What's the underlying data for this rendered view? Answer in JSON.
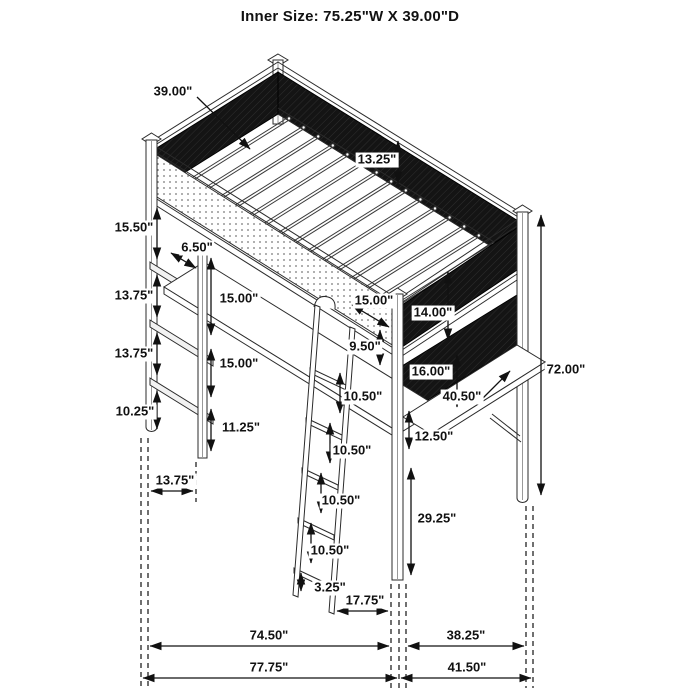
{
  "title": "Inner Size: 75.25\"W X 39.00\"D",
  "colors": {
    "line": "#2b2b2b",
    "mesh_panel": "#141414",
    "dim": "#111111",
    "background": "#ffffff"
  },
  "diagram_subject": "metal loft bed with desk, shelves and ladder",
  "labels": [
    {
      "id": "inner-depth",
      "text": "39.00\"",
      "x": 173,
      "y": 92
    },
    {
      "id": "guard-rail-height",
      "text": "13.25\"",
      "x": 377,
      "y": 160
    },
    {
      "id": "bed-to-shelf1",
      "text": "15.50\"",
      "x": 134,
      "y": 228
    },
    {
      "id": "shelf-depth",
      "text": "6.50\"",
      "x": 197,
      "y": 248
    },
    {
      "id": "shelf1-to-shelf2",
      "text": "13.75\"",
      "x": 134,
      "y": 296
    },
    {
      "id": "shelf2-to-shelf3",
      "text": "13.75\"",
      "x": 134,
      "y": 354
    },
    {
      "id": "shelf3-to-floor",
      "text": "10.25\"",
      "x": 135,
      "y": 412
    },
    {
      "id": "desk-clearance-upper",
      "text": "15.00\"",
      "x": 239,
      "y": 299
    },
    {
      "id": "desk-clearance-lower",
      "text": "15.00\"",
      "x": 239,
      "y": 364
    },
    {
      "id": "leg-lower-section",
      "text": "11.25\"",
      "x": 241,
      "y": 428
    },
    {
      "id": "left-base-offset",
      "text": "13.75\"",
      "x": 175,
      "y": 481
    },
    {
      "id": "rail-to-post",
      "text": "15.00\"",
      "x": 374,
      "y": 301
    },
    {
      "id": "right-panel-upper",
      "text": "14.00\"",
      "x": 433,
      "y": 313
    },
    {
      "id": "hook-to-rung1",
      "text": "9.50\"",
      "x": 365,
      "y": 347
    },
    {
      "id": "right-panel-lower",
      "text": "16.00\"",
      "x": 431,
      "y": 372
    },
    {
      "id": "right-desk-width",
      "text": "40.50\"",
      "x": 462,
      "y": 397
    },
    {
      "id": "rung1-to-rung2",
      "text": "10.50\"",
      "x": 363,
      "y": 397
    },
    {
      "id": "panel-to-desk",
      "text": "12.50\"",
      "x": 434,
      "y": 437
    },
    {
      "id": "rung2-to-rung3",
      "text": "10.50\"",
      "x": 352,
      "y": 451
    },
    {
      "id": "rung3-to-rung4",
      "text": "10.50\"",
      "x": 341,
      "y": 501
    },
    {
      "id": "desk-to-floor",
      "text": "29.25\"",
      "x": 437,
      "y": 519
    },
    {
      "id": "rung4-to-rung5",
      "text": "10.50\"",
      "x": 330,
      "y": 551
    },
    {
      "id": "overall-height",
      "text": "72.00\"",
      "x": 566,
      "y": 370
    },
    {
      "id": "ladder-foot",
      "text": "3.25\"",
      "x": 330,
      "y": 588
    },
    {
      "id": "ladder-offset",
      "text": "17.75\"",
      "x": 365,
      "y": 601
    },
    {
      "id": "inner-span-left",
      "text": "74.50\"",
      "x": 269,
      "y": 636
    },
    {
      "id": "outer-span-left",
      "text": "77.75\"",
      "x": 269,
      "y": 668
    },
    {
      "id": "inner-span-right",
      "text": "38.25\"",
      "x": 466,
      "y": 636
    },
    {
      "id": "outer-span-right",
      "text": "41.50\"",
      "x": 467,
      "y": 668
    }
  ]
}
